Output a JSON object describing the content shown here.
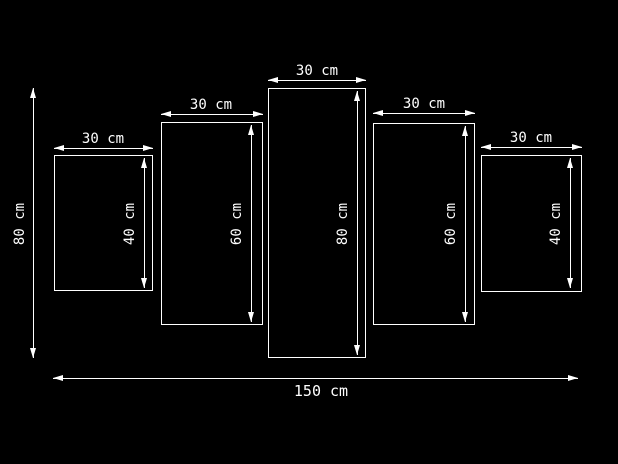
{
  "colors": {
    "background": "#000000",
    "line": "#ffffff",
    "text": "#ffffff"
  },
  "overall": {
    "height_label": "80 cm",
    "width_label": "150 cm"
  },
  "panels": [
    {
      "width_label": "30 cm",
      "height_label": "40 cm"
    },
    {
      "width_label": "30 cm",
      "height_label": "60 cm"
    },
    {
      "width_label": "30 cm",
      "height_label": "80 cm"
    },
    {
      "width_label": "30 cm",
      "height_label": "60 cm"
    },
    {
      "width_label": "30 cm",
      "height_label": "40 cm"
    }
  ]
}
